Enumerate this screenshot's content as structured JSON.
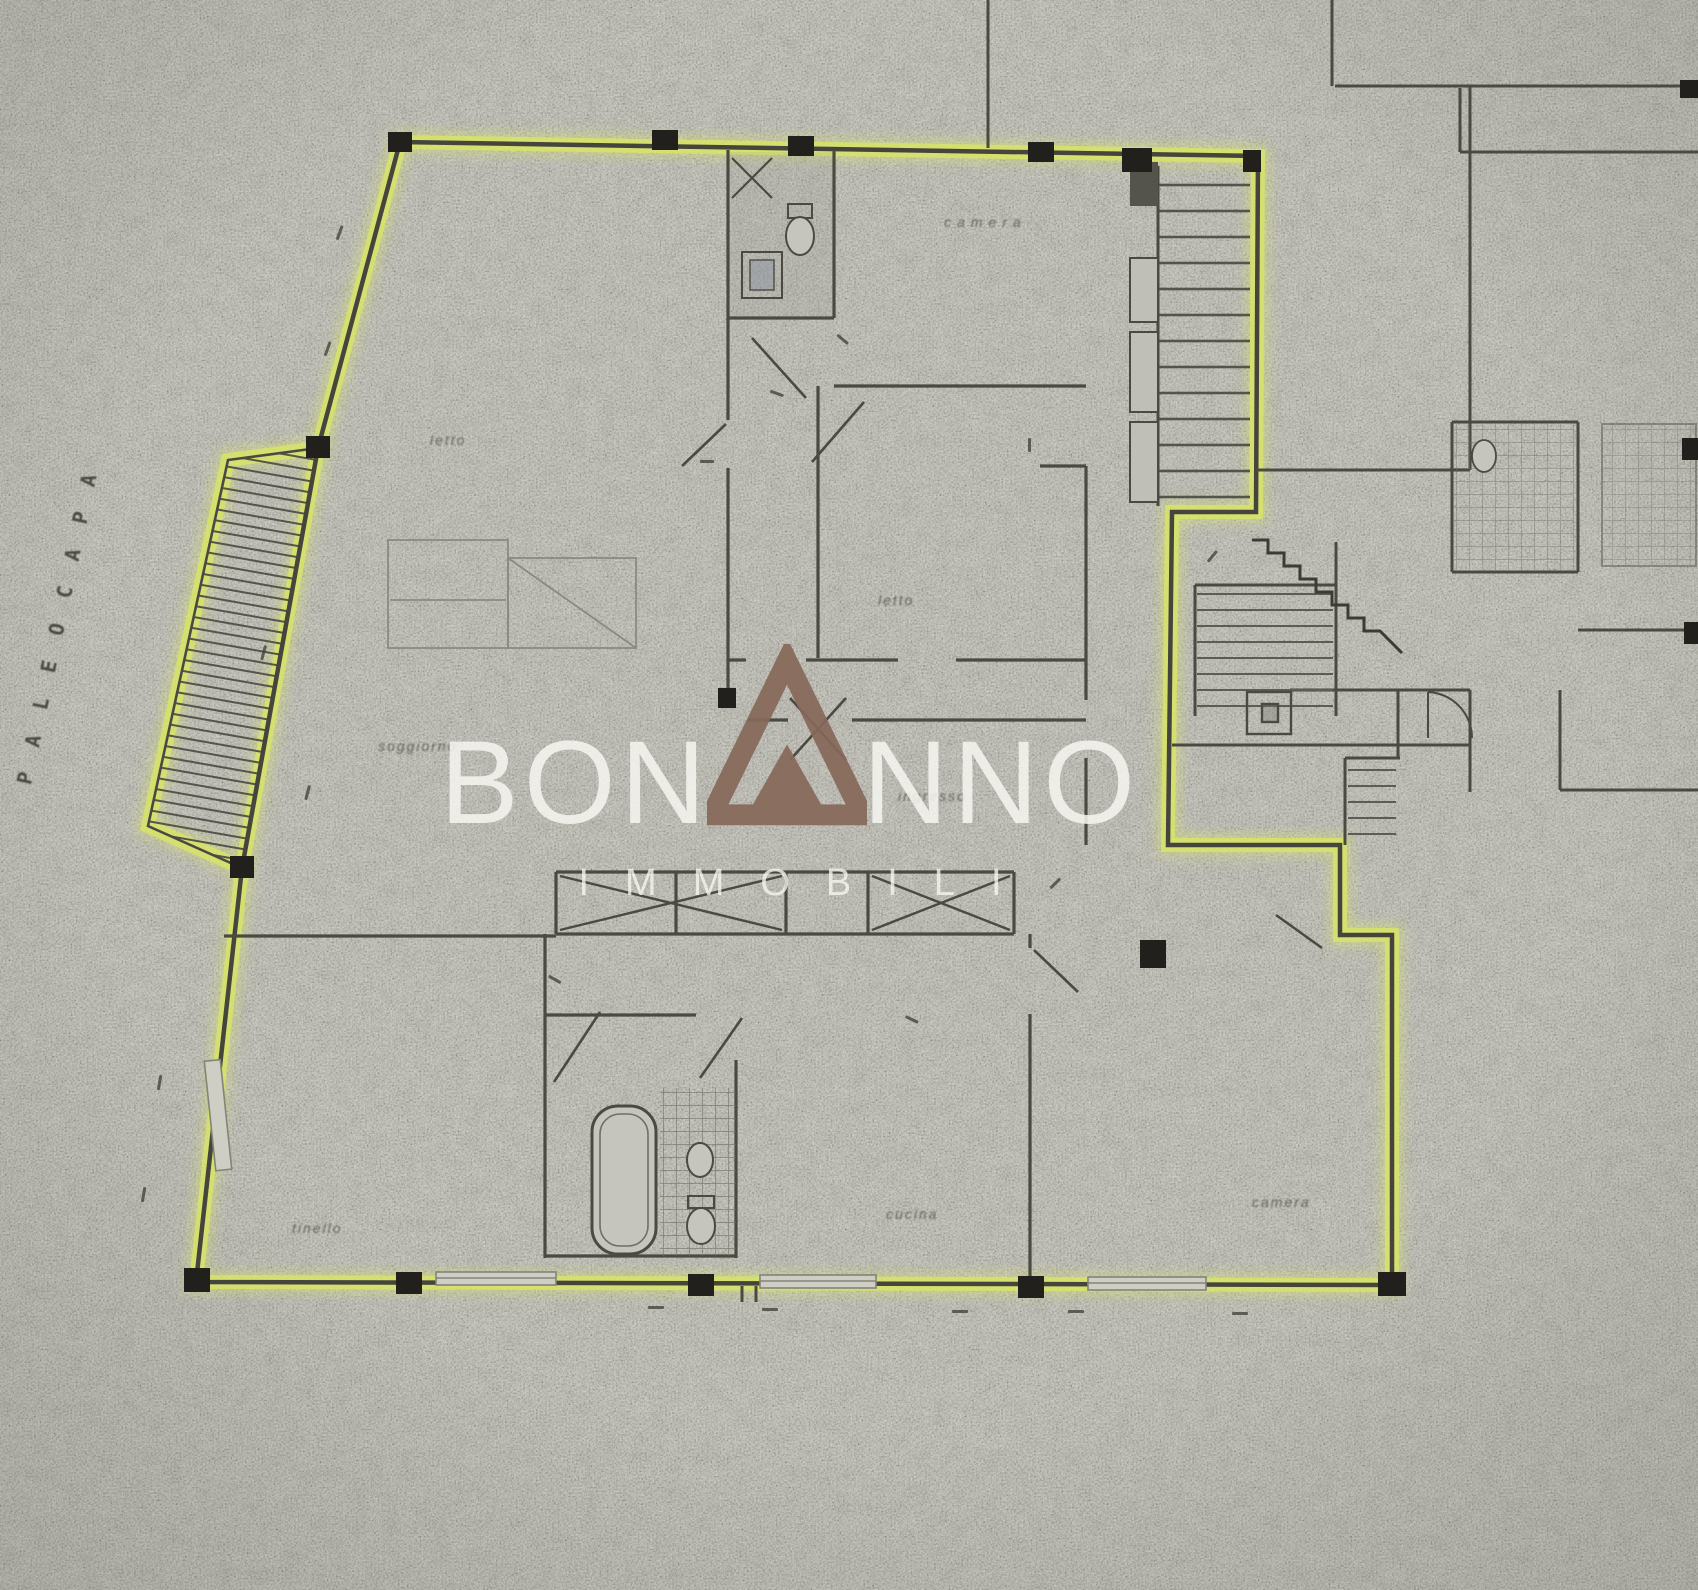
{
  "page": {
    "title": "Scanned apartment floor plan with highlighted perimeter"
  },
  "street_label": "PALEOCAPA",
  "watermark": {
    "brand_left": "BON",
    "brand_right": "NNO",
    "subbrand": "IMMOBILI",
    "triangle_color": "#86695A",
    "text_color": "#F6F5F0"
  },
  "palette": {
    "paper": "#B9B8B1",
    "ink": "#4B4A42",
    "highlight": "#D8E567",
    "pier": "#21201C"
  },
  "room_labels": [
    "letto",
    "camera",
    "letto",
    "soggiorno",
    "ingresso",
    "tinello",
    "cucina",
    "camera"
  ]
}
